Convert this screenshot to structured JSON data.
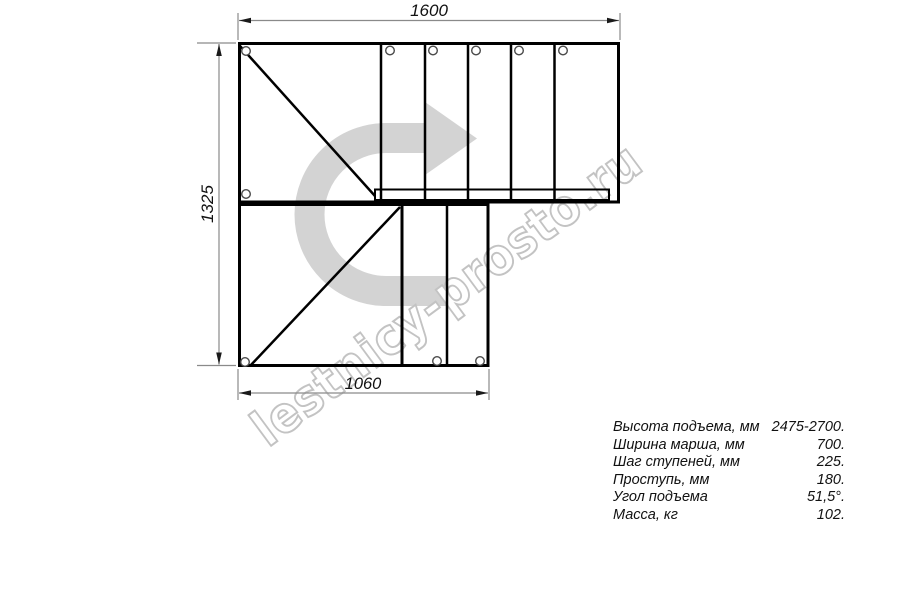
{
  "watermark": {
    "text": "lestnicy-prosto.ru"
  },
  "drawing": {
    "title": "L-shaped staircase plan (top view)",
    "dimensions": {
      "top_width_mm": "1600",
      "left_height_mm": "1325",
      "bottom_width_mm": "1060"
    }
  },
  "specs": {
    "rows": [
      {
        "label": "Высота подъема, мм",
        "value": "2475-2700."
      },
      {
        "label": "Ширина марша, мм",
        "value": "700."
      },
      {
        "label": "Шаг ступеней, мм",
        "value": "225."
      },
      {
        "label": "Проступь, мм",
        "value": "180."
      },
      {
        "label": "Угол подъема",
        "value": "51,5°."
      },
      {
        "label": "Масса, кг",
        "value": "102."
      }
    ]
  },
  "colors": {
    "line_black": "#000000",
    "dim_gray": "#8a8a8a",
    "arrow_gray": "#d3d3d3",
    "watermark_outline": "#c3c3c3"
  }
}
